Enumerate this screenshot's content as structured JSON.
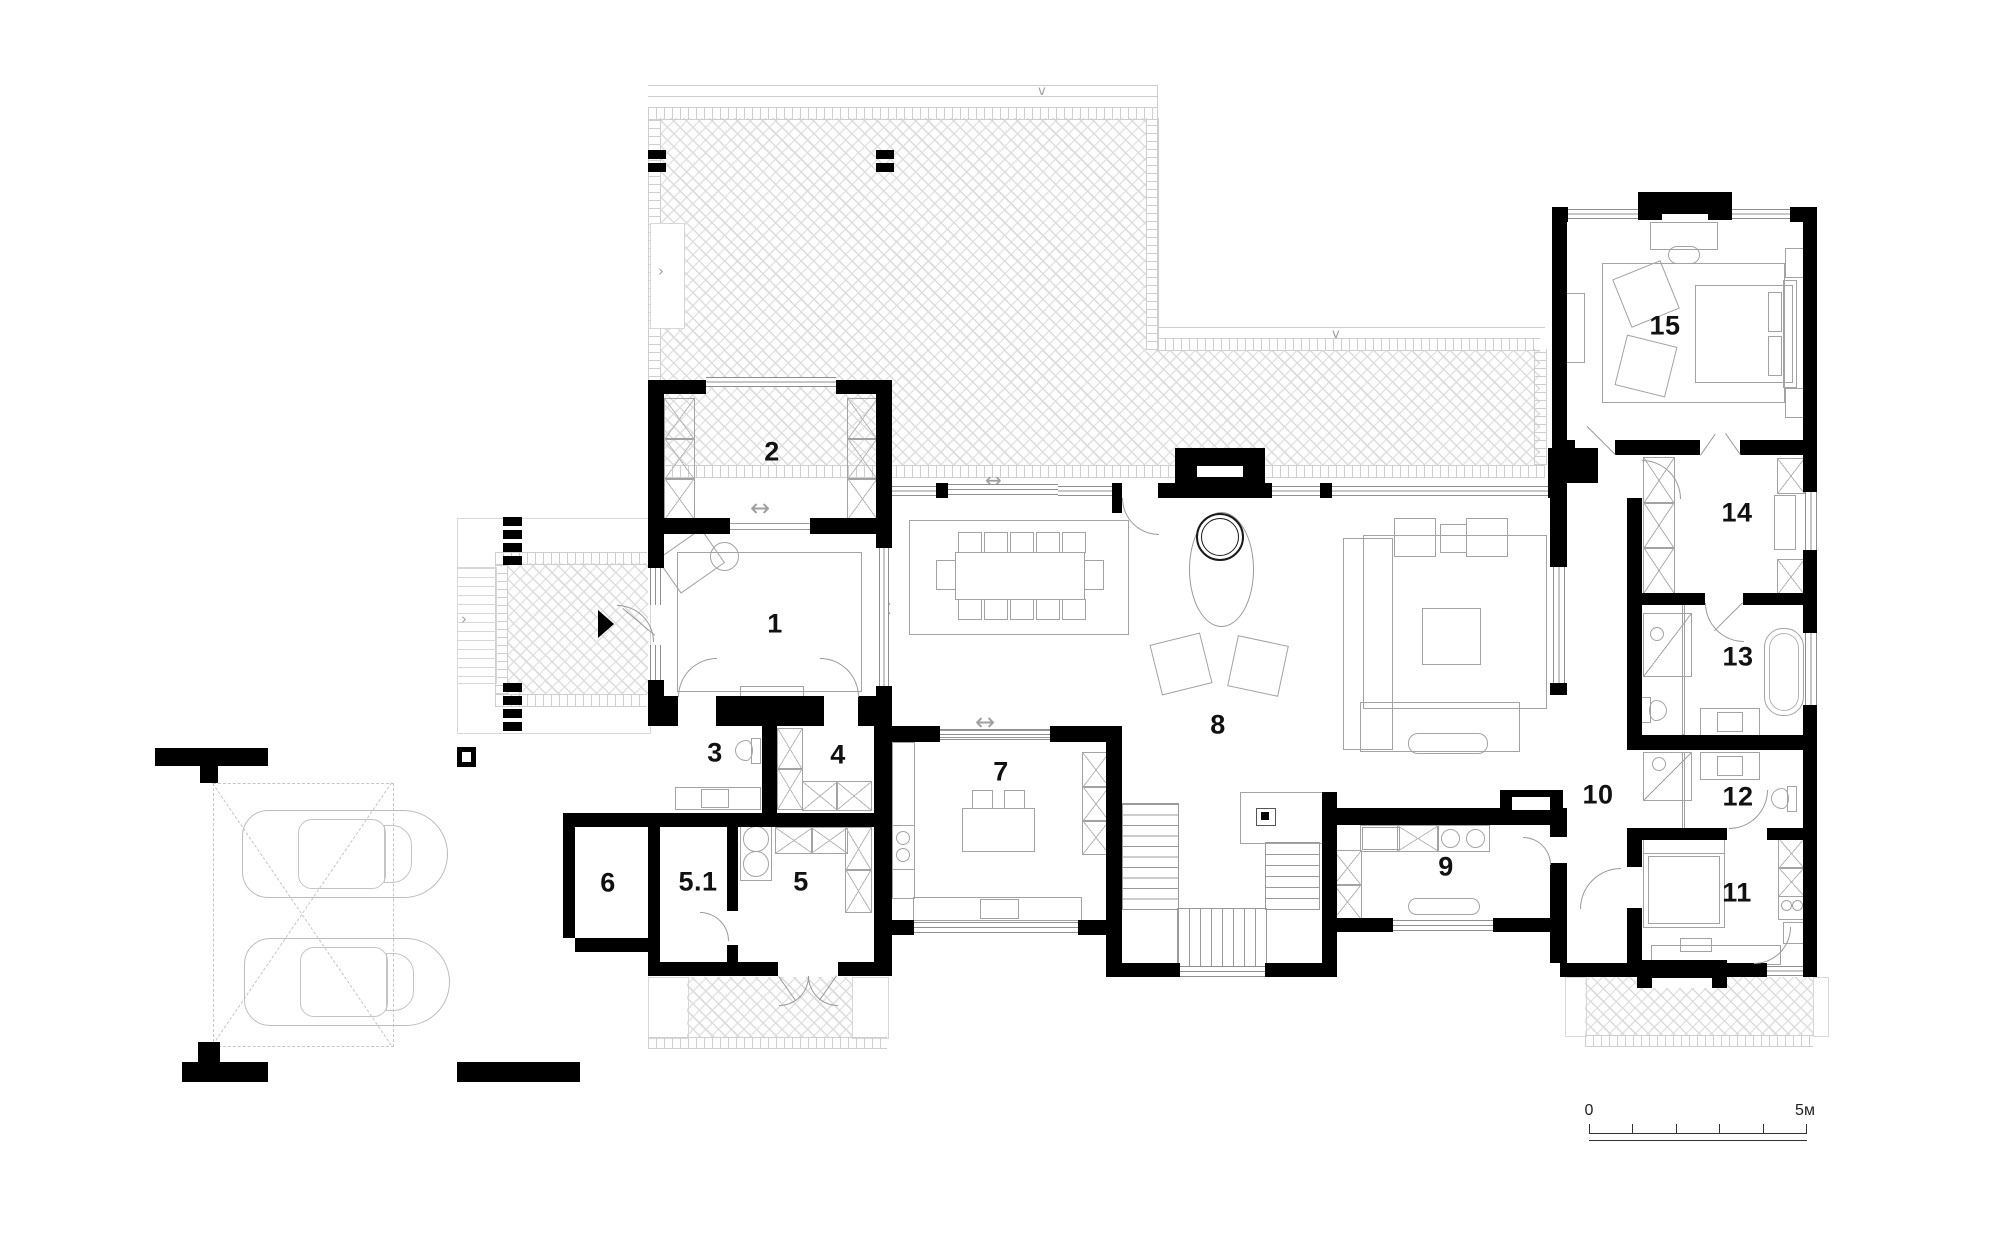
{
  "rooms": [
    {
      "id": "room-1",
      "label": "1"
    },
    {
      "id": "room-2",
      "label": "2"
    },
    {
      "id": "room-3",
      "label": "3"
    },
    {
      "id": "room-4",
      "label": "4"
    },
    {
      "id": "room-5",
      "label": "5"
    },
    {
      "id": "room-5-1",
      "label": "5.1"
    },
    {
      "id": "room-6",
      "label": "6"
    },
    {
      "id": "room-7",
      "label": "7"
    },
    {
      "id": "room-8",
      "label": "8"
    },
    {
      "id": "room-9",
      "label": "9"
    },
    {
      "id": "room-10",
      "label": "10"
    },
    {
      "id": "room-11",
      "label": "11"
    },
    {
      "id": "room-12",
      "label": "12"
    },
    {
      "id": "room-13",
      "label": "13"
    },
    {
      "id": "room-14",
      "label": "14"
    },
    {
      "id": "room-15",
      "label": "15"
    }
  ],
  "scale_bar": {
    "start_label": "0",
    "end_label": "5м"
  },
  "colors": {
    "wall": "#000000",
    "furniture_line": "#a3a3a3",
    "hatch_line": "#dcdcdc",
    "label_text": "#111111"
  }
}
